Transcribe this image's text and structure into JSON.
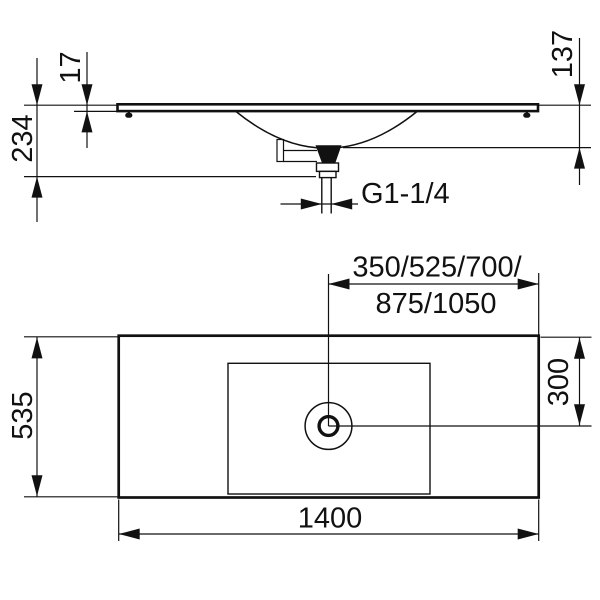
{
  "colors": {
    "line": "#111111",
    "background": "#ffffff"
  },
  "side_view": {
    "dim_slab_thickness": "17",
    "dim_overall_height": "234",
    "dim_outlet_height": "137",
    "dim_drain_thread": "G1-1/4"
  },
  "plan_view": {
    "dim_drain_offsets_1": "350/525/700/",
    "dim_drain_offsets_2": "875/1050",
    "dim_drain_from_rear": "300",
    "dim_depth": "535",
    "dim_width": "1400"
  }
}
